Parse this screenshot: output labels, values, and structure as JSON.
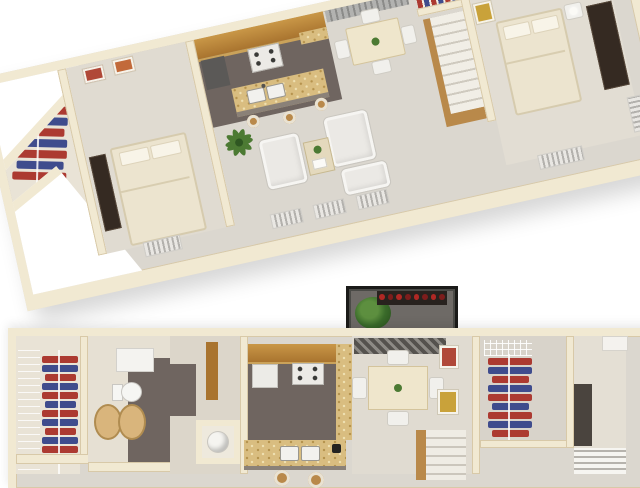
{
  "scene": {
    "type": "apartment-3d-floor-plan-rendering",
    "background": "#ffffff",
    "views": [
      {
        "id": "perspective-view",
        "description": "3D tilted cutaway floor plan, upper half",
        "rotation_deg": -12.5
      },
      {
        "id": "top-down-view",
        "description": "Overhead floor plan, lower half, cropped at image bottom"
      }
    ]
  },
  "colors": {
    "wall": "#f1e9d2",
    "wall_shadow": "#d8c9a8",
    "floor": "#dbd7cf",
    "floor_warm": "#e9e3d6",
    "floor_dark": "#6f6560",
    "wood": "#a9742f",
    "wood_light": "#c99747",
    "granite": "#d9bd80",
    "cloth_red": "#ac3a31",
    "cloth_blue": "#3f4c8d",
    "bed": "#ece4cf",
    "dark_furn": "#352a22",
    "plant": "#4c7a33",
    "stair_wood": "#b9894a",
    "balcony_rail": "#1b1b19",
    "art_red": "#b04838",
    "art_yellow": "#c9a23a"
  },
  "counts": {
    "wing_closet_garments": 7,
    "left_closet_garments": 12,
    "right_closet_garments": 9,
    "balcony_flowers": 8
  },
  "rooms": {
    "perspective_view": [
      "walk-in-closet",
      "bedroom-1",
      "kitchen",
      "dining-area",
      "living-room",
      "stairs",
      "bedroom-2",
      "upper-closet"
    ],
    "top_down_view": [
      "walk-in-closet",
      "bathroom",
      "hallway",
      "utility-closet",
      "kitchen",
      "dining-area",
      "balcony",
      "closet-2",
      "bedroom-hall",
      "stairs",
      "linen-shelves"
    ]
  },
  "furniture": {
    "kitchen": [
      "wood-cabinets",
      "refrigerator",
      "stove",
      "granite-island",
      "double-sink",
      "bar-stools",
      "coffee-maker"
    ],
    "living_room": [
      "white-armchairs",
      "loveseat",
      "coffee-table",
      "palm-plant"
    ],
    "dining": [
      "square-table",
      "four-chairs",
      "vertical-blinds"
    ],
    "bedrooms": [
      "bed",
      "pillows",
      "dresser",
      "nightstand-lamp",
      "wardrobe"
    ],
    "bathroom": [
      "tub-counter",
      "toilet",
      "double-wood-vanity"
    ],
    "balcony": [
      "black-lattice-railing",
      "potted-plant",
      "red-flower-planter"
    ],
    "utility": [
      "water-heater"
    ]
  },
  "visible_text": []
}
